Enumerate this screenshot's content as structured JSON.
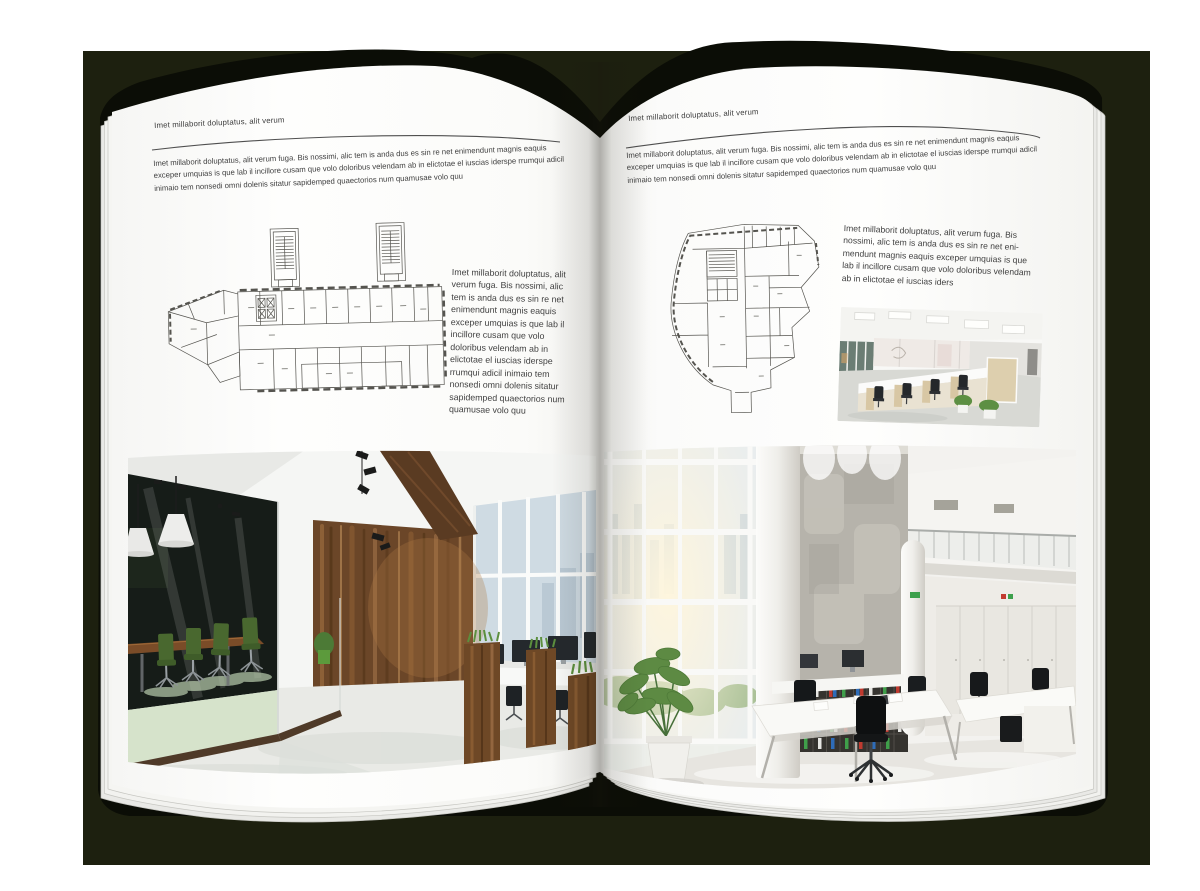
{
  "document": {
    "type": "brochure-spread-mockup",
    "left_page": {
      "header": "Imet millaborit doluptatus, alit verum",
      "intro": "Imet millaborit doluptatus, alit verum fuga. Bis nossimi, alic tem is anda dus es sin re net enimendunt magnis eaquis exceper umquias is que lab il incillore cusam que volo doloribus velendam ab in elictotae el iuscias iderspe rrumqui adicil inimaio tem nonsedi omni dolenis sitatur sapidemped quaectorios num quamusae volo quu",
      "side_text": "Imet millaborit doluptatus, alit verum fuga. Bis nossimi, alic tem is anda dus es sin re net enimendunt magnis eaquis exceper umquias is que lab il incillore cusam que volo doloribus velendam ab in elictotae el iuscias iderspe rrumqui adicil inimaio tem nonsedi omni dolenis sitatur sapidemped quaectorios num quamusae volo quu",
      "floorplan_label": "wide-office-building-floor-plan",
      "photo_label": "loft-style-office-interior-photo"
    },
    "right_page": {
      "header": "Imet millaborit doluptatus, alit verum",
      "intro": "Imet millaborit doluptatus, alit verum fuga. Bis nossimi, alic tem is anda dus es sin re net enimendunt magnis eaquis exceper umquias is que lab il incillore cusam que volo doloribus velendam ab in elictotae el iuscias iderspe rrumqui adicil inimaio tem nonsedi omni dolenis sitatur sapidemped quaectorios num quamusae volo quu",
      "caption": "Imet millaborit doluptatus, alit verum fuga. Bis nossimi, alic tem is anda dus es sin re net eni-mendunt magnis eaquis exceper umquias is que lab il incillore cusam que volo doloribus velendam ab in elictotae el iuscias iders",
      "floorplan_label": "irregular-office-building-floor-plan",
      "photo_small_label": "open-plan-office-cubicles-photo",
      "photo_large_label": "atrium-office-interior-photo"
    }
  },
  "colors": {
    "canvas": "#ffffff",
    "backdrop": "#1d200f",
    "book_cover": "#0b0d06",
    "page": "#fdfdfc",
    "text": "#3f3f3f",
    "rule": "#4f4f4f",
    "wood": "#6e4827",
    "meeting_room_glass": "#161c18",
    "chair_green": "#49682f",
    "plant_green": "#5d8a43",
    "binder_green": "#3f9e4a",
    "binder_red": "#bf3a2f",
    "binder_blue": "#2e6cb8"
  }
}
